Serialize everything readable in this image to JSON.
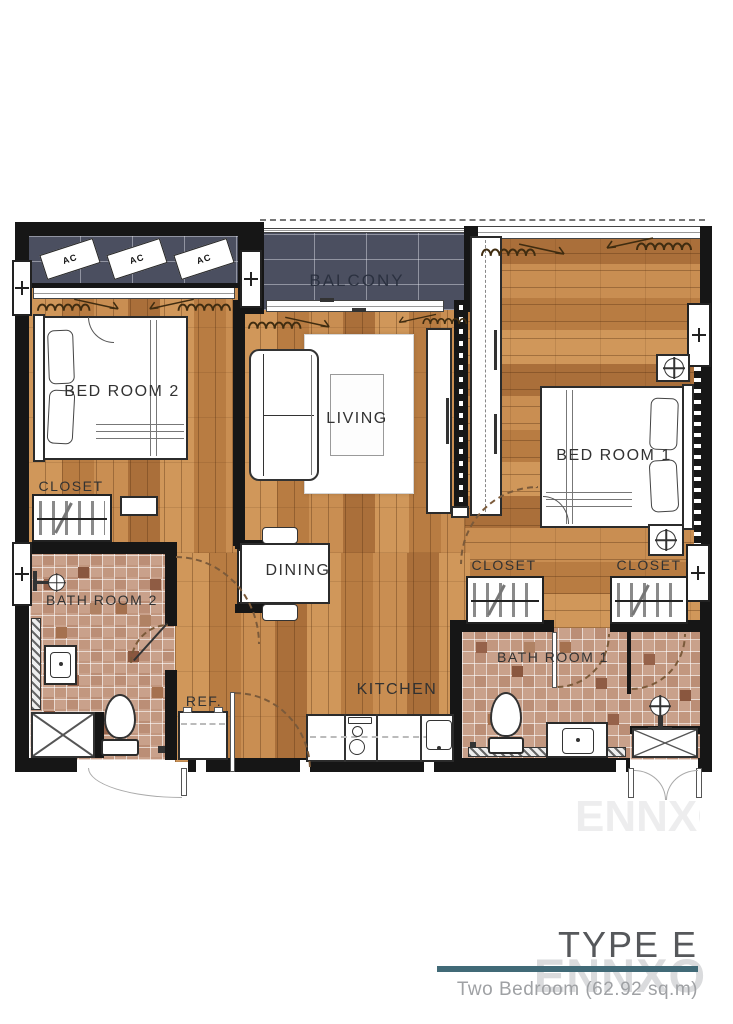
{
  "rooms": {
    "balcony": "BALCONY",
    "bedroom2": "BED ROOM 2",
    "living": "LIVING",
    "bedroom1": "BED ROOM 1",
    "closet": "CLOSET",
    "bathroom2": "BATH ROOM 2",
    "bathroom1": "BATH ROOM 1",
    "dining": "DINING",
    "kitchen": "KITCHEN",
    "refrigerator": "REF.",
    "ac_unit": "AC"
  },
  "title_block": {
    "type_label": "TYPE E",
    "subtitle": "Two Bedroom (62.92 sq.m)",
    "watermark": "ENNXO"
  },
  "colors": {
    "wood_floor": "#c08045",
    "balcony_tile": "#4b4f60",
    "bathroom_tile": "#c9a18b",
    "wall": "#161616",
    "accent_rule": "#416a77",
    "title_text": "#56585b",
    "subtitle_text": "#9fa1a4",
    "watermark_text": "#dadbdd"
  }
}
